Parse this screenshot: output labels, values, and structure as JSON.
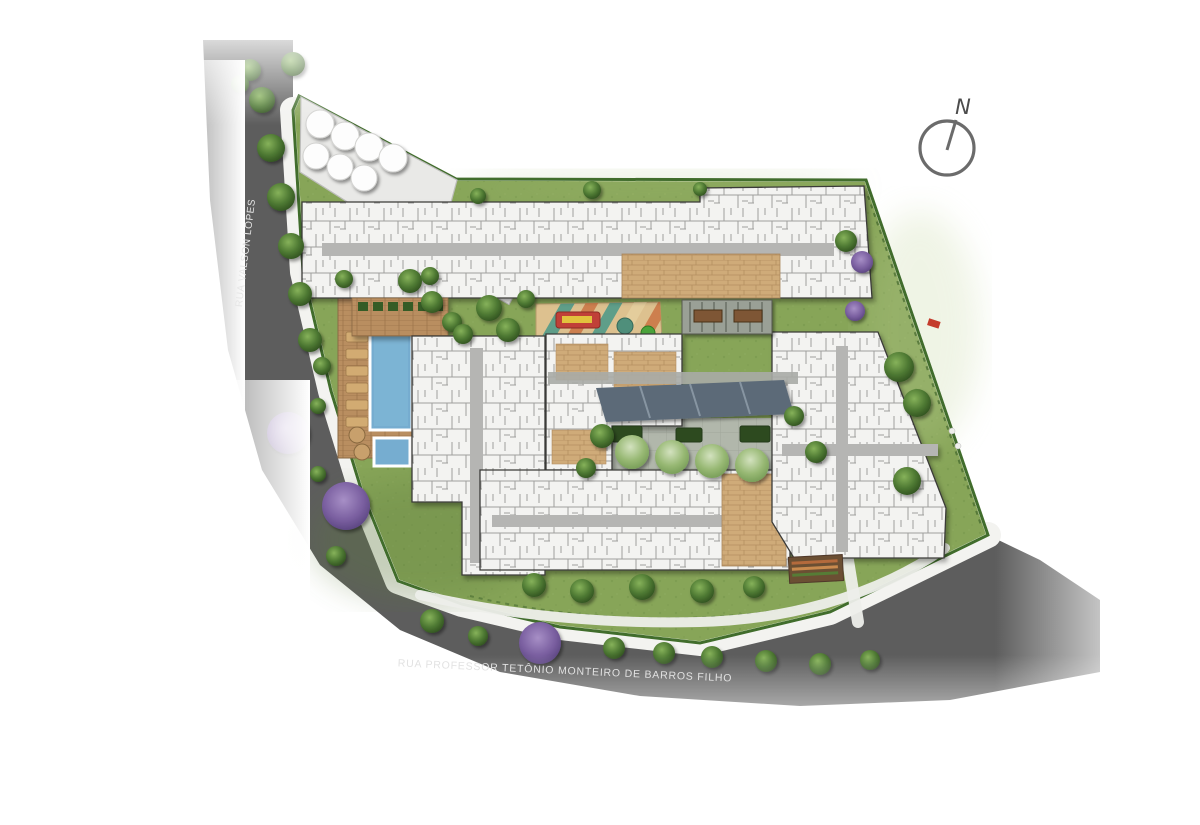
{
  "compass": {
    "label": "N"
  },
  "streets": {
    "left": {
      "name": "RUA VALSON LOPES"
    },
    "bottom": {
      "name": "RUA PROFESSOR TETÔNIO MONTEIRO DE BARROS FILHO"
    }
  },
  "legend_features": [
    "north-compass-icon",
    "road-surface",
    "sidewalk-path",
    "site-lawn",
    "water-tanks",
    "swimming-pool",
    "kids-pool",
    "pool-deck",
    "lounge-chairs",
    "playground",
    "pergola-tables",
    "canopy-walkway",
    "central-courtyard",
    "community-garden",
    "residential-buildings",
    "street-trees",
    "flowering-trees",
    "shrubs"
  ],
  "colors": {
    "background": "#ffffff",
    "road": "#5d5d5d",
    "lawn": "#87a558",
    "building": "#f3f3f1",
    "pool_water": "#76add0",
    "wood_deck": "#b98e60",
    "canopy": "#5c6b78",
    "playground_teal": "#5f9e89",
    "playground_orange": "#cd7f4e",
    "flowering_tree": "#7a5fa0",
    "accent_red": "#c43b2c"
  }
}
